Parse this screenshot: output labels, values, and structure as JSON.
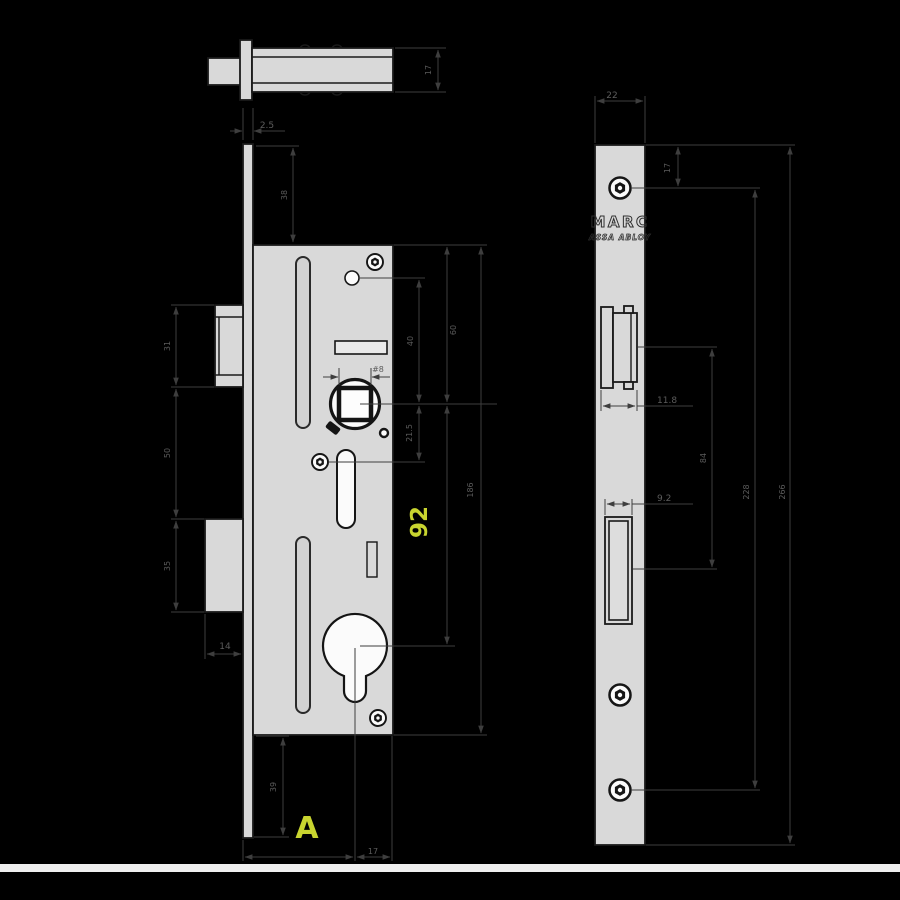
{
  "title": "Mortise lock technical drawing",
  "brand": {
    "name": "MARC",
    "logo_sub": "ASSA ABLOY"
  },
  "colors": {
    "background": "#000000",
    "metal_fill": "#d9d9d9",
    "part_outline": "#1a1a1a",
    "dimension_line": "#3e3e3e",
    "dimension_text": "#5c5c5c",
    "accent_yellow": "#c8d42f"
  },
  "dimensions": {
    "top_view": {
      "latch_height": "17"
    },
    "front_view": {
      "faceplate_thickness": "2.5",
      "plate_top_to_case_top": "38",
      "hole_to_spindle_center": "40",
      "spindle_square": "#8",
      "spindle_to_screw": "21.5",
      "case_top_to_spindle": "60",
      "spindle_to_cylinder": "92",
      "case_top_to_bottom_screw": "186",
      "latch_bolt_height": "31",
      "latch_to_deadbolt_gap": "50",
      "deadbolt_height": "35",
      "deadbolt_throw": "14",
      "case_bottom_to_plate_end": "39",
      "backset_label": "A",
      "cylinder_to_case_back": "17"
    },
    "side_view": {
      "faceplate_width": "22",
      "plate_top_to_screw": "17",
      "latch_projection": "11.8",
      "deadbolt_projection": "9.2",
      "latch_to_deadbolt_centers": "84",
      "screw_spacing": "228",
      "faceplate_length": "266"
    }
  }
}
